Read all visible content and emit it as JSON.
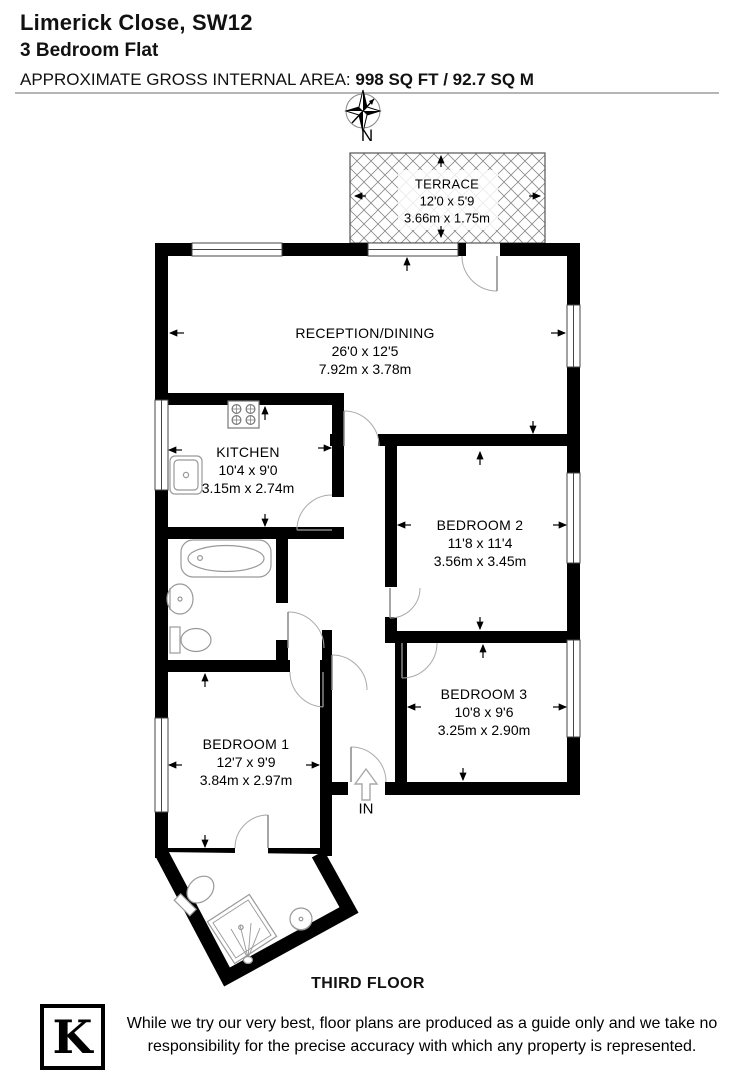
{
  "header": {
    "address": "Limerick Close, SW12",
    "property_type": "3 Bedroom Flat",
    "area_label": "APPROXIMATE GROSS INTERNAL AREA:",
    "area_value": "998 SQ FT / 92.7 SQ M"
  },
  "compass": {
    "north_label": "N"
  },
  "rooms": [
    {
      "id": "terrace",
      "name": "TERRACE",
      "dims_ft": "12'0 x 5'9",
      "dims_m": "3.66m x 1.75m"
    },
    {
      "id": "reception",
      "name": "RECEPTION/DINING",
      "dims_ft": "26'0 x 12'5",
      "dims_m": "7.92m x 3.78m"
    },
    {
      "id": "kitchen",
      "name": "KITCHEN",
      "dims_ft": "10'4 x 9'0",
      "dims_m": "3.15m x 2.74m"
    },
    {
      "id": "bedroom2",
      "name": "BEDROOM 2",
      "dims_ft": "11'8 x 11'4",
      "dims_m": "3.56m x 3.45m"
    },
    {
      "id": "bedroom3",
      "name": "BEDROOM 3",
      "dims_ft": "10'8 x 9'6",
      "dims_m": "3.25m x 2.90m"
    },
    {
      "id": "bedroom1",
      "name": "BEDROOM 1",
      "dims_ft": "12'7 x 9'9",
      "dims_m": "3.84m x 2.97m"
    }
  ],
  "entrance_label": "IN",
  "floor_label": "THIRD FLOOR",
  "footer": {
    "logo_letter": "K",
    "disclaimer": "While we try our very best, floor plans are produced as a guide only and we take no responsibility for the precise accuracy with which any property is represented."
  },
  "colors": {
    "wall": "#000000",
    "fixture": "#999999",
    "hatch": "#8a8a8a",
    "rule": "#b5b5b5"
  }
}
